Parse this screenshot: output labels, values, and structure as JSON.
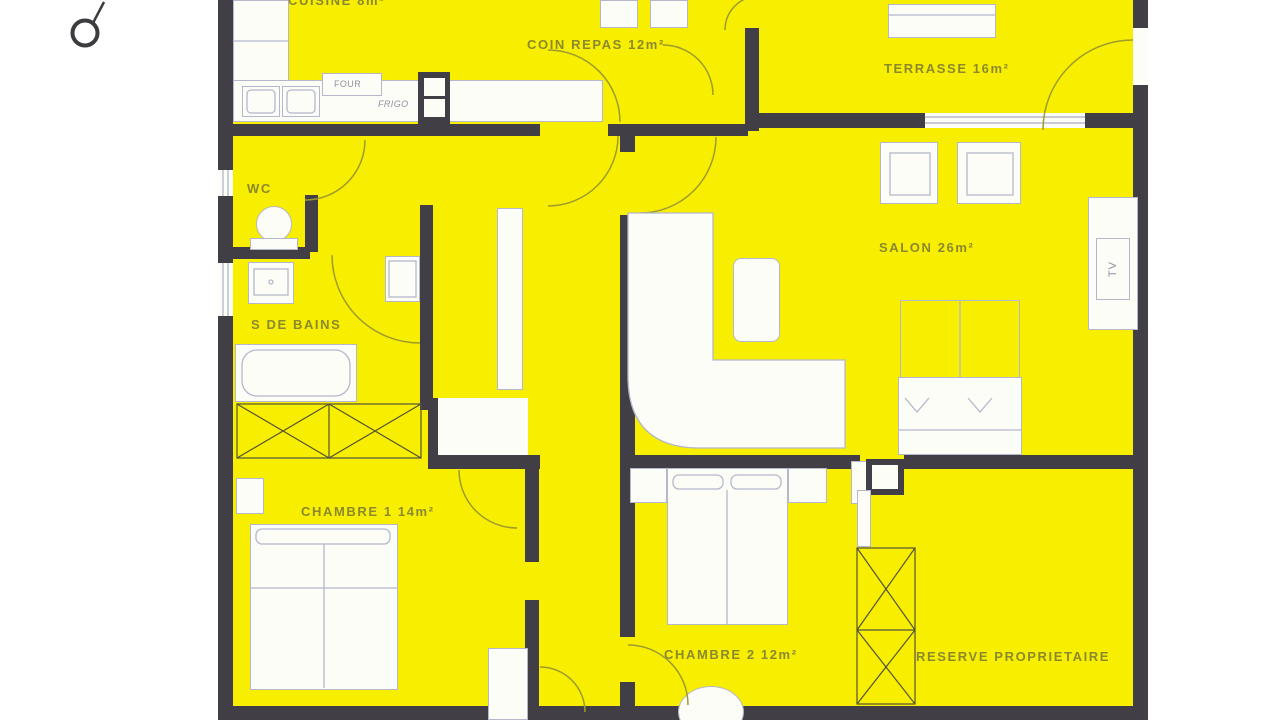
{
  "colors": {
    "room_fill": "#f8ee00",
    "wall": "#413f45",
    "furniture_outline": "#b4b8ca",
    "label_text": "#8b8930"
  },
  "rooms": {
    "cuisine": {
      "label": "CUISINE 8m²"
    },
    "coin_repas": {
      "label": "COIN REPAS 12m²"
    },
    "terrasse": {
      "label": "TERRASSE 16m²"
    },
    "salon": {
      "label": "SALON 26m²"
    },
    "wc": {
      "label": "WC"
    },
    "salle_de_bains": {
      "label": "S DE BAINS"
    },
    "chambre_1": {
      "label": "CHAMBRE 1 14m²"
    },
    "chambre_2": {
      "label": "CHAMBRE 2 12m²"
    },
    "reserve": {
      "label": "RESERVE PROPRIETAIRE"
    }
  },
  "appliances": {
    "four": {
      "label": "FOUR"
    },
    "frigo": {
      "label": "FRIGO"
    },
    "tv": {
      "label": "TV"
    }
  }
}
